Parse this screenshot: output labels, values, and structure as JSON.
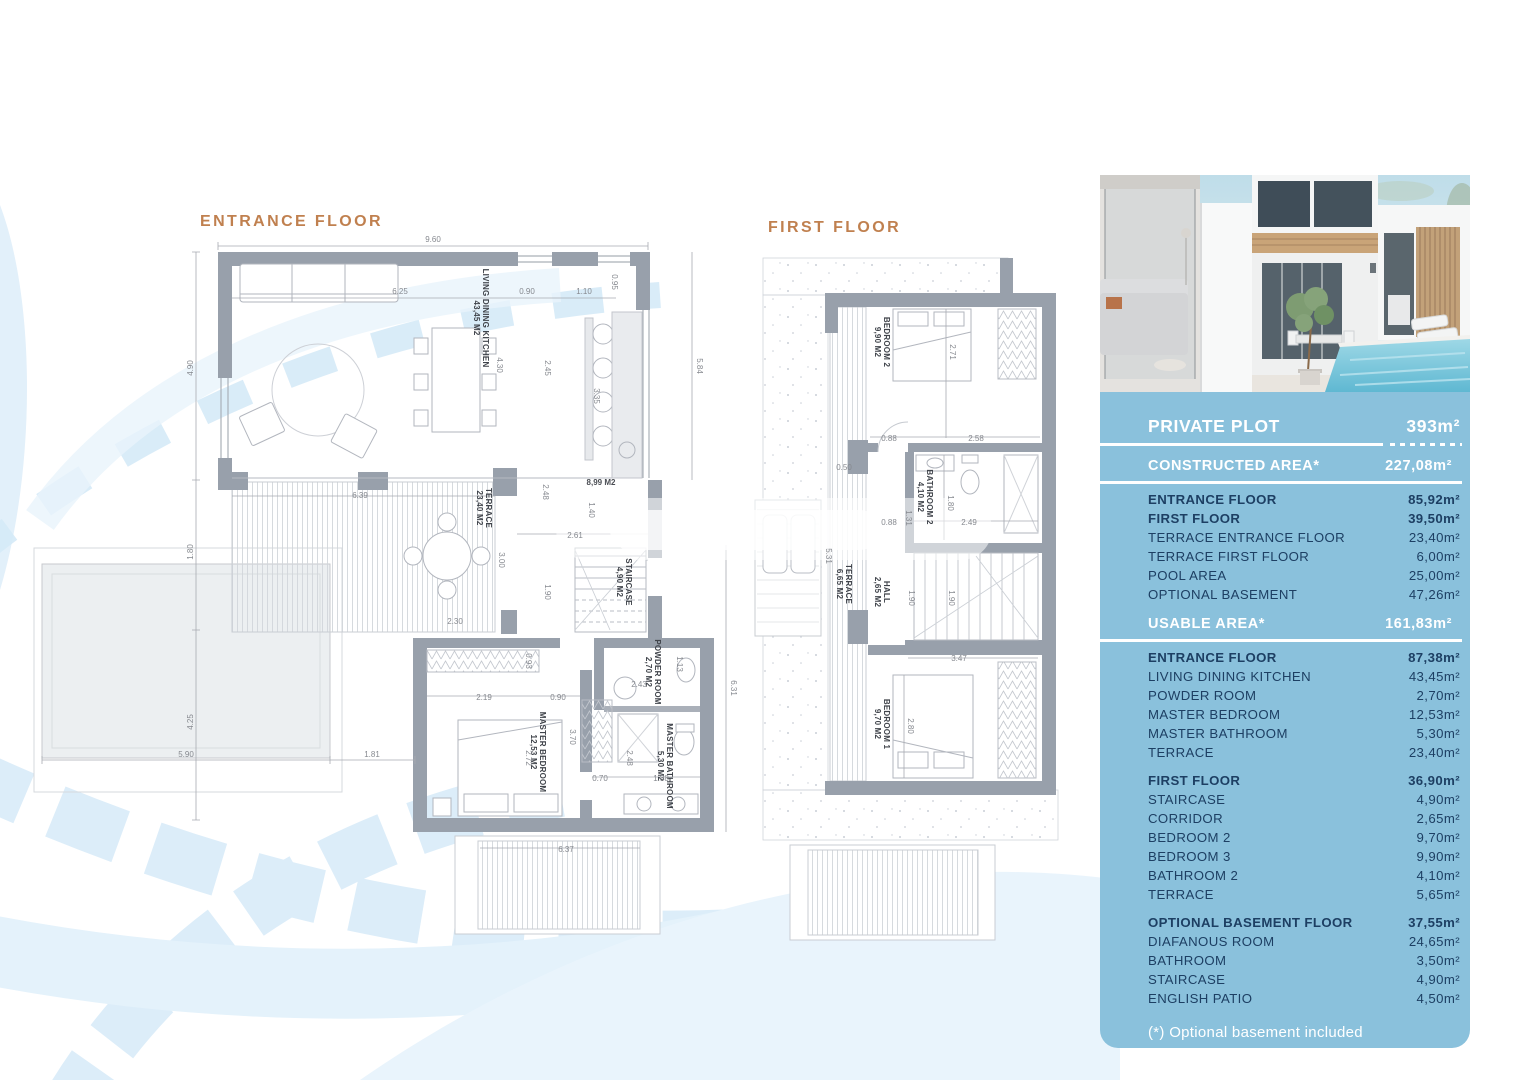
{
  "colors": {
    "accent": "#c0804f",
    "panel_bg": "#8ac1dc",
    "navy": "#1d3f63",
    "wall": "#98a0ab",
    "watermark": "#ddeef9"
  },
  "titles": {
    "entrance": "ENTRANCE FLOOR",
    "first": "FIRST FLOOR"
  },
  "plans": {
    "entrance": {
      "rooms": [
        {
          "label": "LIVING DINING KITCHEN",
          "area": "43,45 M2"
        },
        {
          "label": "TERRACE",
          "area": "23,40 M2"
        },
        {
          "label": "STAIRCASE",
          "area": "4,90 M2"
        },
        {
          "label": "POWDER ROOM",
          "area": "2,70 M2"
        },
        {
          "label": "MASTER BEDROOM",
          "area": "12,53 M2"
        },
        {
          "label": "MASTER BATHROOM",
          "area": "5,30 M2"
        }
      ],
      "dims": [
        "9.60",
        "4.90",
        "1.80",
        "4.25",
        "5.90",
        "1.81",
        "6.25",
        "0.90",
        "1.10",
        "0.95",
        "4.30",
        "2.45",
        "3.35",
        "5.84",
        "8,99 M2",
        "2.48",
        "1.40",
        "6.39",
        "2.61",
        "3.00",
        "1.90",
        "2.30",
        "6.31",
        "2.43",
        "1.13",
        "0.93",
        "2.19",
        "0.90",
        "3.70",
        "2.72",
        "0.70",
        "1.88",
        "2.48",
        "6.37"
      ]
    },
    "first": {
      "rooms": [
        {
          "label": "BEDROOM 2",
          "area": "9,90 M2"
        },
        {
          "label": "BATHROOM 2",
          "area": "4,10 M2"
        },
        {
          "label": "TERRACE",
          "area": "6,65 M2"
        },
        {
          "label": "HALL",
          "area": "2,65 M2"
        },
        {
          "label": "BEDROOM 1",
          "area": "9,70 M2"
        }
      ],
      "dims": [
        "2.71",
        "0.88",
        "2.58",
        "0.50",
        "0.88",
        "1.31",
        "2.49",
        "1.80",
        "1.90",
        "1.90",
        "3.47",
        "2.80",
        "5.31"
      ]
    }
  },
  "panel": {
    "plot": {
      "label": "PRIVATE PLOT",
      "value": "393m²"
    },
    "rows": [
      {
        "label": "CONSTRUCTED AREA*",
        "value": "227,08m²",
        "style": "header"
      },
      {
        "label": "ENTRANCE FLOOR",
        "value": "85,92m²",
        "style": "bold"
      },
      {
        "label": "FIRST FLOOR",
        "value": "39,50m²",
        "style": "bold"
      },
      {
        "label": "TERRACE ENTRANCE FLOOR",
        "value": "23,40m²",
        "style": "row"
      },
      {
        "label": "TERRACE FIRST FLOOR",
        "value": "6,00m²",
        "style": "row"
      },
      {
        "label": "POOL AREA",
        "value": "25,00m²",
        "style": "row"
      },
      {
        "label": "OPTIONAL BASEMENT",
        "value": "47,26m²",
        "style": "row"
      },
      {
        "label": "USABLE AREA*",
        "value": "161,83m²",
        "style": "header"
      },
      {
        "label": "ENTRANCE FLOOR",
        "value": "87,38m²",
        "style": "bold"
      },
      {
        "label": "LIVING DINING KITCHEN",
        "value": "43,45m²",
        "style": "row"
      },
      {
        "label": "POWDER ROOM",
        "value": "2,70m²",
        "style": "row"
      },
      {
        "label": "MASTER BEDROOM",
        "value": "12,53m²",
        "style": "row"
      },
      {
        "label": "MASTER BATHROOM",
        "value": "5,30m²",
        "style": "row"
      },
      {
        "label": "TERRACE",
        "value": "23,40m²",
        "style": "row"
      },
      {
        "label": "FIRST FLOOR",
        "value": "36,90m²",
        "style": "bold",
        "gap": true
      },
      {
        "label": "STAIRCASE",
        "value": "4,90m²",
        "style": "row"
      },
      {
        "label": "CORRIDOR",
        "value": "2,65m²",
        "style": "row"
      },
      {
        "label": "BEDROOM 2",
        "value": "9,70m²",
        "style": "row"
      },
      {
        "label": "BEDROOM 3",
        "value": "9,90m²",
        "style": "row"
      },
      {
        "label": "BATHROOM 2",
        "value": "4,10m²",
        "style": "row"
      },
      {
        "label": "TERRACE",
        "value": "5,65m²",
        "style": "row"
      },
      {
        "label": "OPTIONAL BASEMENT FLOOR",
        "value": "37,55m²",
        "style": "bold",
        "gap": true
      },
      {
        "label": "DIAFANOUS ROOM",
        "value": "24,65m²",
        "style": "row"
      },
      {
        "label": "BATHROOM",
        "value": "3,50m²",
        "style": "row"
      },
      {
        "label": "STAIRCASE",
        "value": "4,90m²",
        "style": "row"
      },
      {
        "label": "ENGLISH PATIO",
        "value": "4,50m²",
        "style": "row"
      }
    ],
    "footnote": "(*) Optional basement included"
  }
}
